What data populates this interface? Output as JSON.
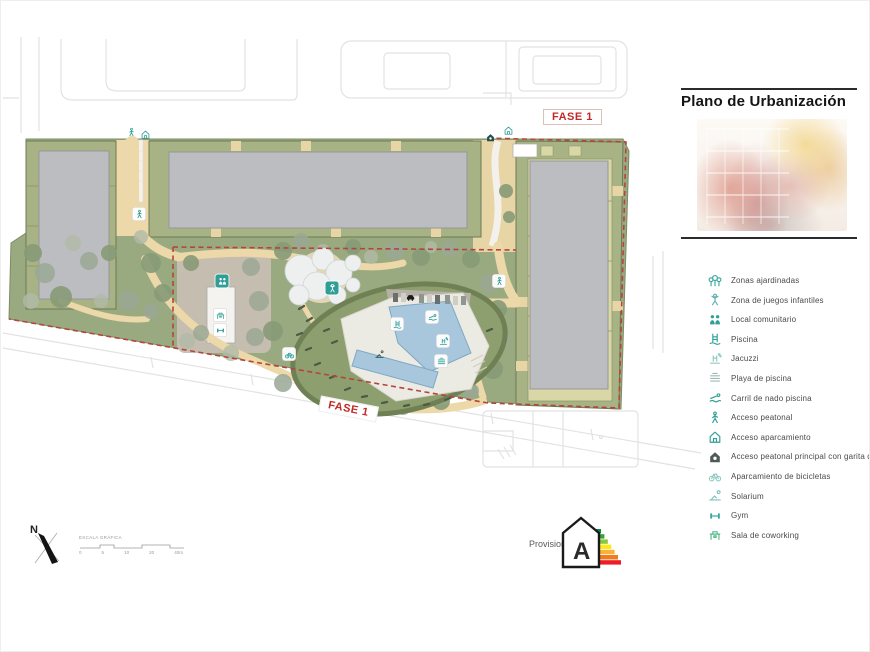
{
  "title_panel": {
    "title": "Plano de Urbanización"
  },
  "plan": {
    "fase1_top": "FASE 1",
    "fase1_bottom": "FASE 1",
    "accent_teal": "#2f9e96",
    "boundary_red": "#b5443c",
    "grass_green": "#9aaa80",
    "building_band_green": "#a7b285",
    "building_gray": "#bcbdc0",
    "path_beige": "#ecd8a8",
    "pool_blue": "#a8c6dc"
  },
  "legend": {
    "items": [
      {
        "icon": "trees-icon",
        "label": "Zonas ajardinadas",
        "color": "#3aa79e"
      },
      {
        "icon": "playground-icon",
        "label": "Zona de juegos infantiles",
        "color": "#5fb3ac"
      },
      {
        "icon": "community-icon",
        "label": "Local comunitario",
        "color": "#2f9e96"
      },
      {
        "icon": "pool-ladder-icon",
        "label": "Piscina",
        "color": "#2f9e96"
      },
      {
        "icon": "jacuzzi-icon",
        "label": "Jacuzzi",
        "color": "#8fcac4"
      },
      {
        "icon": "pool-beach-icon",
        "label": "Playa de piscina",
        "color": "#9fb8b4"
      },
      {
        "icon": "swim-lane-icon",
        "label": "Carril de nado piscina",
        "color": "#2f9e96"
      },
      {
        "icon": "pedestrian-icon",
        "label": "Acceso peatonal",
        "color": "#2f9e96"
      },
      {
        "icon": "parking-access-icon",
        "label": "Acceso aparcamiento",
        "color": "#2f9e96"
      },
      {
        "icon": "gatehouse-icon",
        "label": "Acceso peatonal principal con garita de control",
        "color": "#4d5a58"
      },
      {
        "icon": "bike-parking-icon",
        "label": "Aparcamiento de bicicletas",
        "color": "#8fcac4"
      },
      {
        "icon": "solarium-icon",
        "label": "Solarium",
        "color": "#7fc4bf"
      },
      {
        "icon": "gym-icon",
        "label": "Gym",
        "color": "#3aa79e"
      },
      {
        "icon": "coworking-icon",
        "label": "Sala de coworking",
        "color": "#52b98a"
      }
    ]
  },
  "compass": {
    "label": "N"
  },
  "scale_bar": {
    "label": "ESCALA GRÁFICA",
    "ticks": [
      "0",
      "5",
      "10",
      "20",
      "40m"
    ]
  },
  "energy_label": {
    "text": "Provisional",
    "rating": "A",
    "bar_colors": [
      "#0b8a44",
      "#33a23d",
      "#8cc63e",
      "#f7ec13",
      "#fbb03b",
      "#f47a20",
      "#ee1c25"
    ]
  }
}
